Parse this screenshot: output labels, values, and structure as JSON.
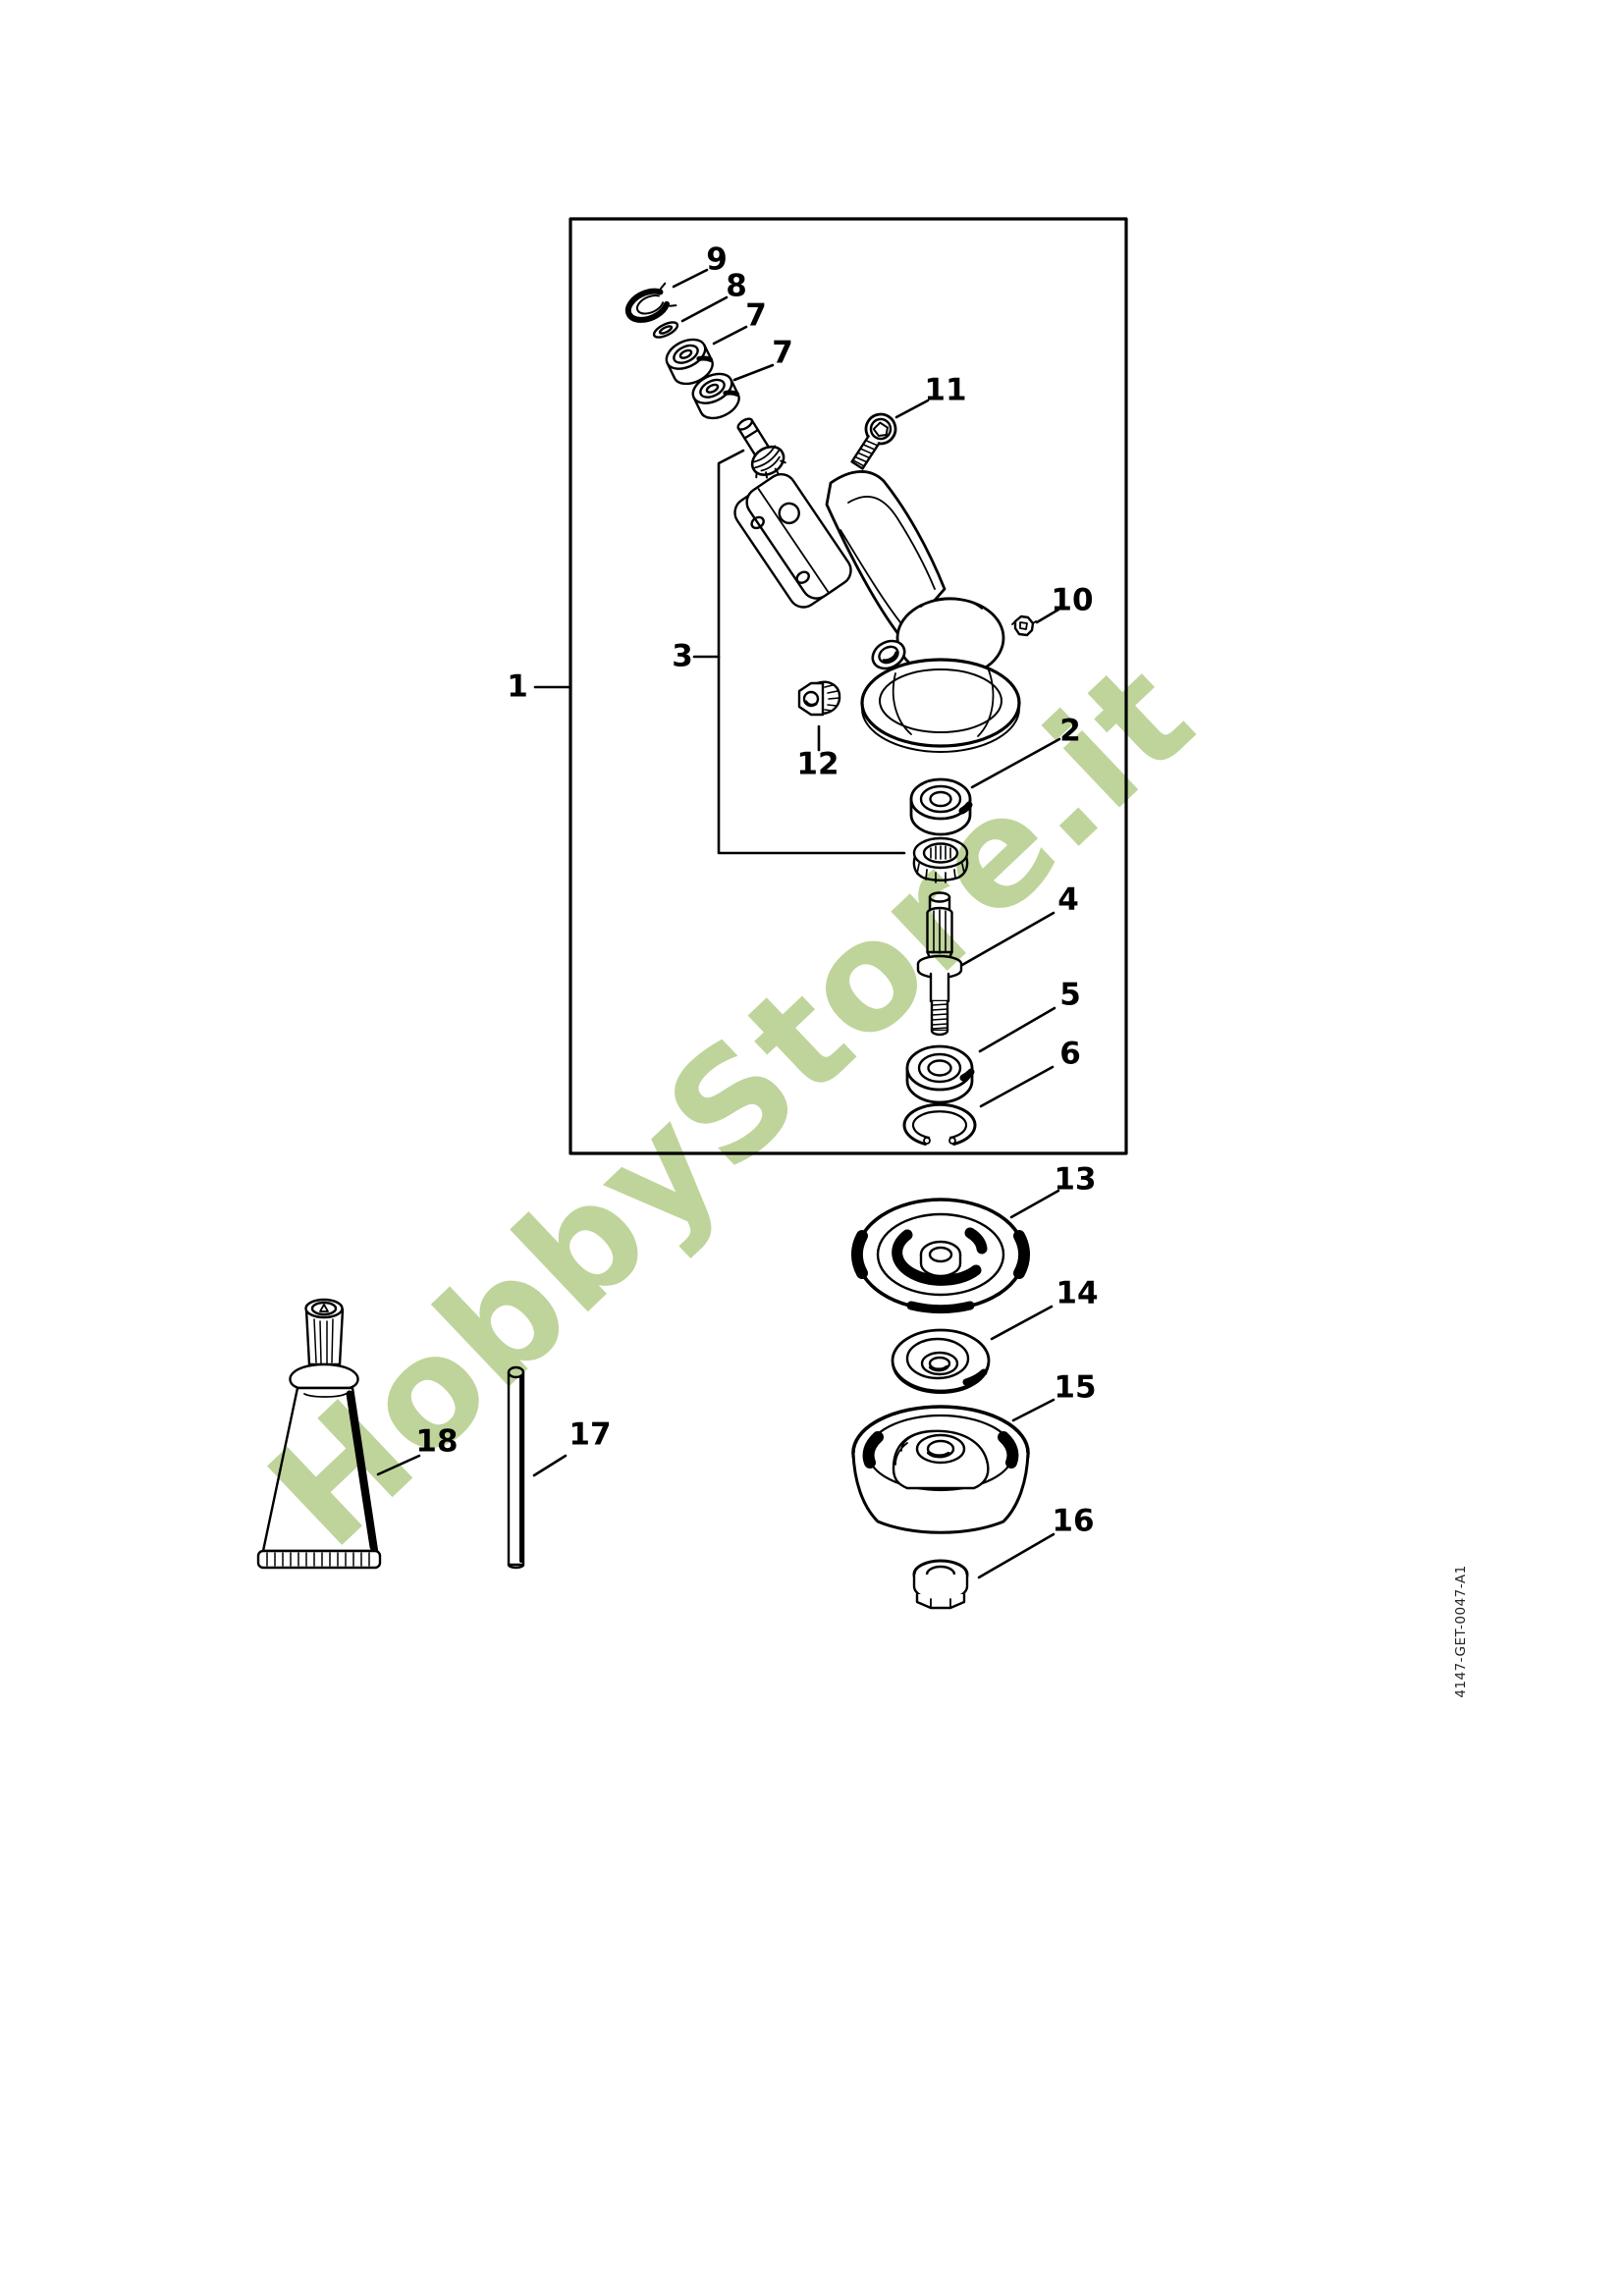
{
  "page": {
    "background_color": "#ffffff",
    "line_color": "#000000"
  },
  "watermark": {
    "text": "HobbyStore.it",
    "color": "#bfd49b"
  },
  "doc_code": {
    "text": "4147-GET-0047-A1"
  },
  "callouts": {
    "p1": "1",
    "p2": "2",
    "p3": "3",
    "p4": "4",
    "p5": "5",
    "p6": "6",
    "p7a": "7",
    "p7b": "7",
    "p8": "8",
    "p9": "9",
    "p10": "10",
    "p11": "11",
    "p12": "12",
    "p13": "13",
    "p14": "14",
    "p15": "15",
    "p16": "16",
    "p17": "17",
    "p18": "18"
  }
}
